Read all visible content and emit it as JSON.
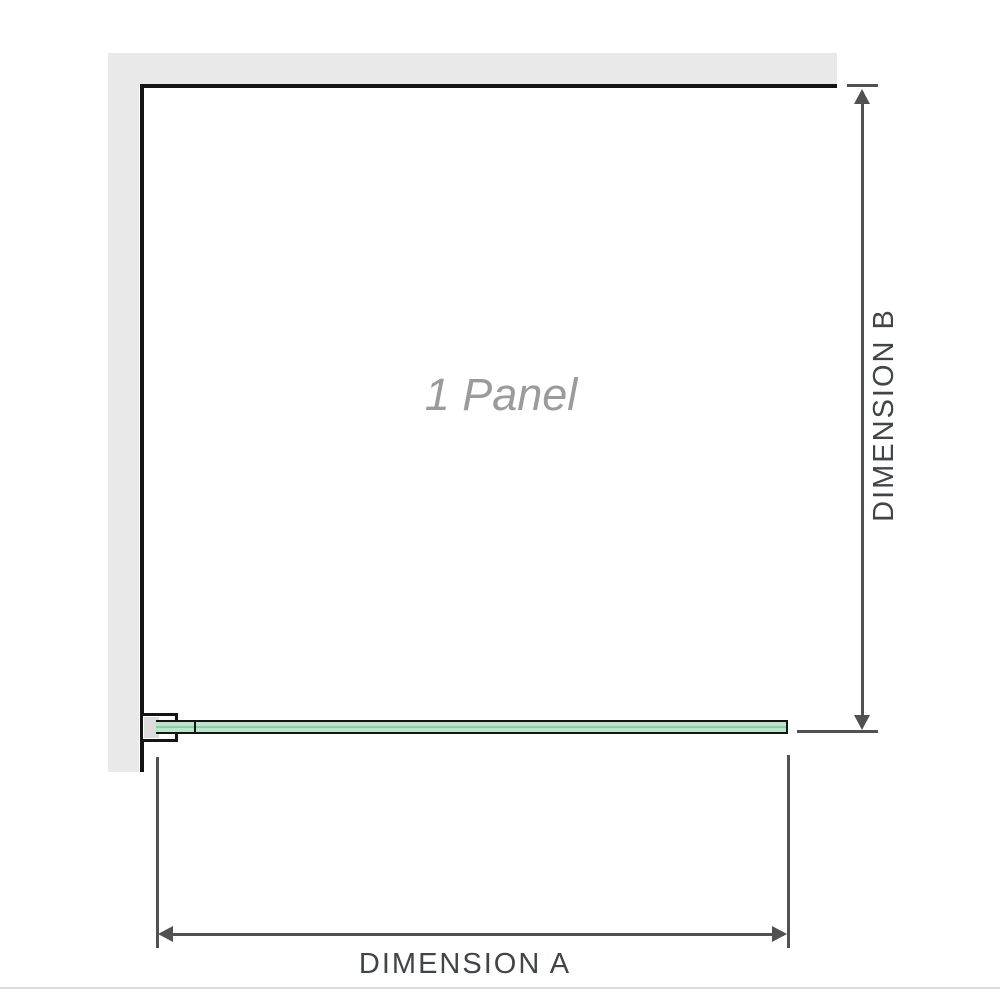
{
  "diagram": {
    "panel_label": "1 Panel",
    "dimension_a_label": "DIMENSION A",
    "dimension_b_label": "DIMENSION B"
  },
  "icons": {
    "dimension_b_top": "arrow-up-icon",
    "dimension_b_bottom": "arrow-down-icon",
    "dimension_a_left": "arrow-left-icon",
    "dimension_a_right": "arrow-right-icon"
  },
  "colors": {
    "wall_fill": "#e9e9e9",
    "wall_edge": "#141414",
    "glass_outline": "#141414",
    "glass_light": "#b9e5cb",
    "glass_mid": "#8aceaa",
    "bracket_fill": "#dcdcdc",
    "dimension_line": "#515151",
    "dimension_text": "#40454a",
    "panel_label_color": "#9b9b9b",
    "divider": "#dcdbd4"
  }
}
